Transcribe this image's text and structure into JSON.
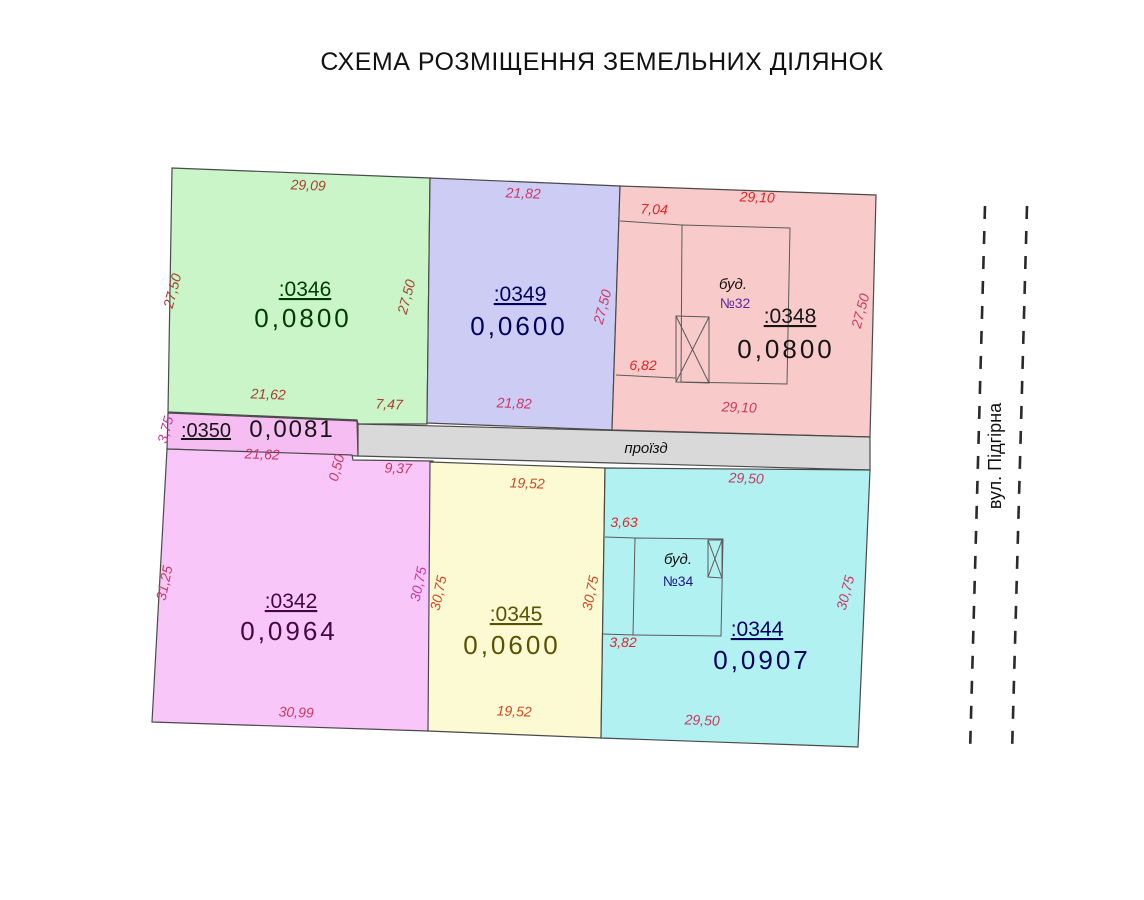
{
  "title": "СХЕМА РОЗМІЩЕННЯ ЗЕМЕЛЬНИХ ДІЛЯНОК",
  "parcels": {
    "p0346": {
      "id": ":0346",
      "area": "0,0800",
      "fill": "#c9f5c9",
      "label_color": "#003c00"
    },
    "p0349": {
      "id": ":0349",
      "area": "0,0600",
      "fill": "#ccccf4",
      "label_color": "#00005e"
    },
    "p0348": {
      "id": ":0348",
      "area": "0,0800",
      "fill": "#f9caca",
      "label_color": "#151515"
    },
    "p0350": {
      "id": ":0350",
      "area": "0,0081",
      "fill": "#f6bdf2",
      "label_color": "#151515"
    },
    "p0342": {
      "id": ":0342",
      "area": "0,0964",
      "fill": "#f9c6f9",
      "label_color": "#42083f"
    },
    "p0345": {
      "id": ":0345",
      "area": "0,0600",
      "fill": "#fbfad2",
      "label_color": "#5a5200"
    },
    "p0344": {
      "id": ":0344",
      "area": "0,0907",
      "fill": "#b2f1f1",
      "label_color": "#00005e"
    }
  },
  "road": {
    "label": "проїзд",
    "fill": "#d9d9d9"
  },
  "street": {
    "label": "вул. Підгірна"
  },
  "buildings": {
    "b32": {
      "label": "буд.",
      "number": "№32",
      "number_color": "#5a2ca0"
    },
    "b34": {
      "label": "буд.",
      "number": "№34",
      "number_color": "#1a1a8c"
    }
  },
  "dims": {
    "p46_top": "29,09",
    "p46_left": "27,50",
    "p46_right": "27,50",
    "p46_bottom": "21,62",
    "p46_bottom_right": "7,47",
    "p49_top": "21,82",
    "p49_right": "27,50",
    "p49_bottom": "21,82",
    "p48_top_offset": "7,04",
    "p48_top": "29,10",
    "p48_bottom_offset": "6,82",
    "p48_bottom": "29,10",
    "p48_right": "27,50",
    "p50_left": "3,75",
    "p50_bottom": "21,62",
    "p50_step": "0,50",
    "p50_road": "9,37",
    "p42_left": "31,25",
    "p42_right": "30,75",
    "p42_bottom": "30,99",
    "p45_top": "19,52",
    "p45_left": "30,75",
    "p45_right": "30,75",
    "p45_bottom": "19,52",
    "p44_top": "29,50",
    "p44_offset_top": "3,63",
    "p44_offset_bottom": "3,82",
    "p44_right": "30,75",
    "p44_bottom": "29,50"
  }
}
